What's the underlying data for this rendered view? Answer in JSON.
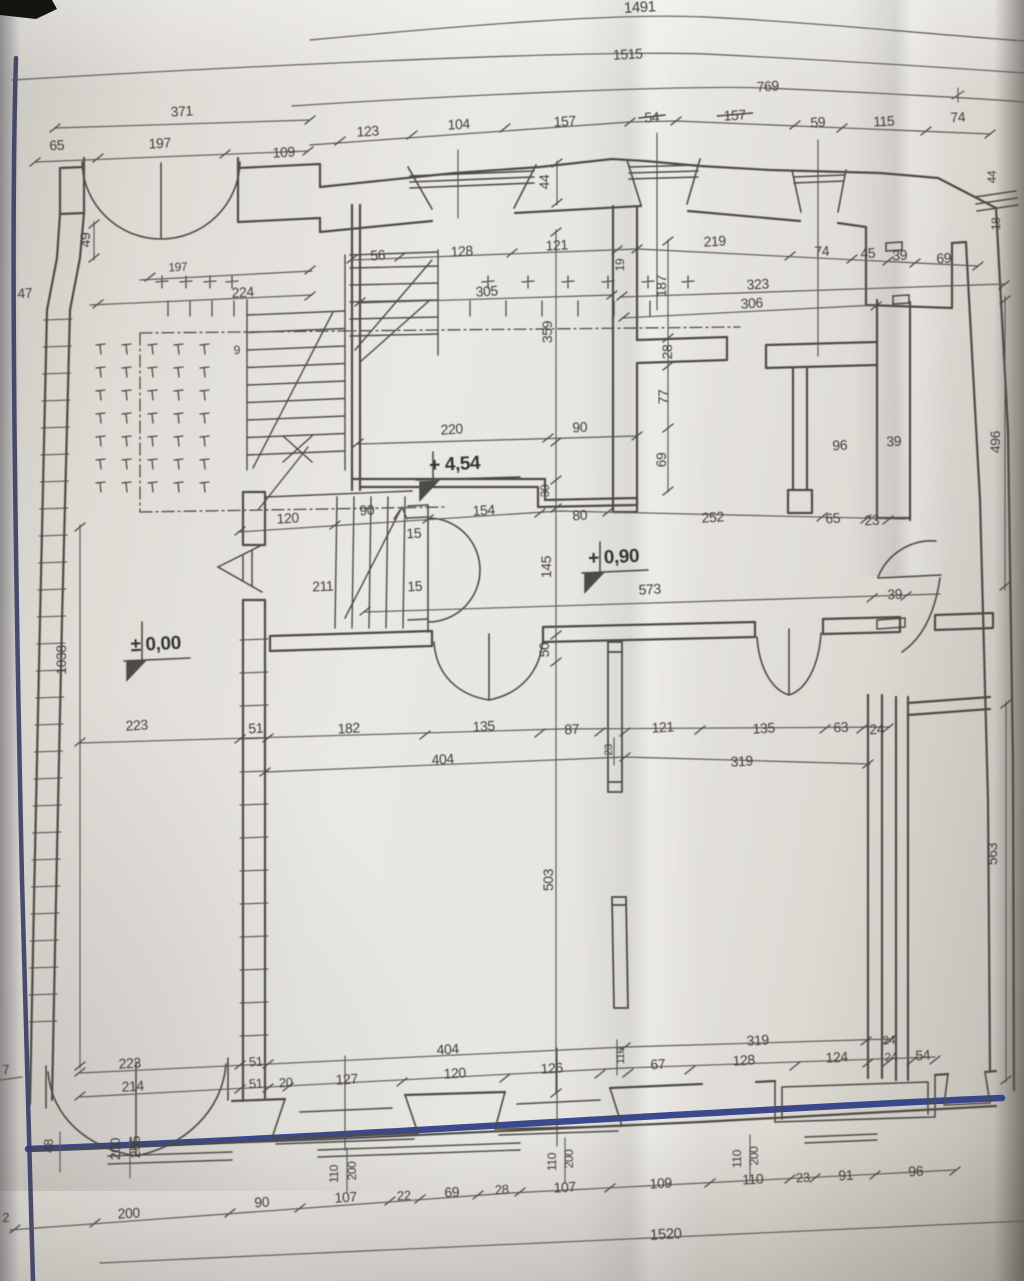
{
  "drawing": {
    "kind": "architectural-floor-plan-photo",
    "elevation_markers": [
      "+ 4,54",
      "+ 0,90",
      "± 0,00"
    ],
    "overall_dimensions": [
      "1491",
      "1515",
      "769",
      "1520",
      "1038"
    ]
  },
  "colors": {
    "ink": "#4d4b45",
    "dim_line": "#5b5952",
    "label": "#3f3d37",
    "paper_light": "#eae8e3",
    "paper_dark": "#c6c3bd",
    "blue_edge": "#383c63",
    "blue_facade": "#2e3c86"
  },
  "labels": [
    {
      "t": "1491",
      "x": 640,
      "y": 12,
      "fs": 15
    },
    {
      "t": "1515",
      "x": 628,
      "y": 59
    },
    {
      "t": "769",
      "x": 768,
      "y": 91
    },
    {
      "t": "371",
      "x": 182,
      "y": 116
    },
    {
      "t": "123",
      "x": 368,
      "y": 136
    },
    {
      "t": "104",
      "x": 459,
      "y": 129
    },
    {
      "t": "157",
      "x": 565,
      "y": 126
    },
    {
      "t": "54",
      "x": 652,
      "y": 122,
      "strike": true
    },
    {
      "t": "157",
      "x": 735,
      "y": 120,
      "strike": true
    },
    {
      "t": "59",
      "x": 818,
      "y": 127
    },
    {
      "t": "115",
      "x": 884,
      "y": 126
    },
    {
      "t": "74",
      "x": 958,
      "y": 122
    },
    {
      "t": "65",
      "x": 57,
      "y": 150
    },
    {
      "t": "197",
      "x": 160,
      "y": 148
    },
    {
      "t": "109",
      "x": 284,
      "y": 157
    },
    {
      "t": "47",
      "x": 25,
      "y": 298
    },
    {
      "t": "49",
      "x": 90,
      "y": 240,
      "r": -90
    },
    {
      "t": "197",
      "x": 178,
      "y": 271,
      "fs": 12
    },
    {
      "t": "224",
      "x": 243,
      "y": 297
    },
    {
      "t": "9",
      "x": 237,
      "y": 354,
      "fs": 12
    },
    {
      "t": "44",
      "x": 549,
      "y": 182,
      "r": -90
    },
    {
      "t": "56",
      "x": 378,
      "y": 260
    },
    {
      "t": "128",
      "x": 462,
      "y": 256
    },
    {
      "t": "121",
      "x": 557,
      "y": 250
    },
    {
      "t": "19",
      "x": 624,
      "y": 265,
      "r": -90,
      "fs": 12
    },
    {
      "t": "187",
      "x": 666,
      "y": 286,
      "r": -90
    },
    {
      "t": "219",
      "x": 715,
      "y": 246
    },
    {
      "t": "74",
      "x": 822,
      "y": 256
    },
    {
      "t": "45",
      "x": 868,
      "y": 258
    },
    {
      "t": "39",
      "x": 900,
      "y": 260
    },
    {
      "t": "69",
      "x": 944,
      "y": 263
    },
    {
      "t": "323",
      "x": 758,
      "y": 289
    },
    {
      "t": "306",
      "x": 752,
      "y": 308
    },
    {
      "t": "305",
      "x": 487,
      "y": 296
    },
    {
      "t": "359",
      "x": 552,
      "y": 332,
      "r": -90
    },
    {
      "t": "28",
      "x": 672,
      "y": 352,
      "r": -90
    },
    {
      "t": "77",
      "x": 668,
      "y": 397,
      "r": -90
    },
    {
      "t": "69",
      "x": 666,
      "y": 460,
      "r": -90
    },
    {
      "t": "44",
      "x": 996,
      "y": 177,
      "r": -90,
      "fs": 12
    },
    {
      "t": "18",
      "x": 1000,
      "y": 224,
      "r": -90,
      "fs": 12
    },
    {
      "t": "496",
      "x": 1000,
      "y": 442,
      "r": -90
    },
    {
      "t": "220",
      "x": 452,
      "y": 434
    },
    {
      "t": "90",
      "x": 580,
      "y": 432
    },
    {
      "t": "96",
      "x": 840,
      "y": 450
    },
    {
      "t": "39",
      "x": 894,
      "y": 446
    },
    {
      "t": "+ 4,54",
      "x": 455,
      "y": 470,
      "fs": 19,
      "b": 1
    },
    {
      "t": "120",
      "x": 288,
      "y": 523
    },
    {
      "t": "90",
      "x": 367,
      "y": 515
    },
    {
      "t": "154",
      "x": 484,
      "y": 515
    },
    {
      "t": "80",
      "x": 580,
      "y": 520
    },
    {
      "t": "252",
      "x": 713,
      "y": 522
    },
    {
      "t": "65",
      "x": 833,
      "y": 523
    },
    {
      "t": "23",
      "x": 872,
      "y": 525
    },
    {
      "t": "15",
      "x": 414,
      "y": 538
    },
    {
      "t": "15",
      "x": 415,
      "y": 591
    },
    {
      "t": "211",
      "x": 323,
      "y": 591
    },
    {
      "t": "145",
      "x": 551,
      "y": 567,
      "r": -90
    },
    {
      "t": "30",
      "x": 549,
      "y": 491,
      "r": -90,
      "fs": 12
    },
    {
      "t": "50",
      "x": 549,
      "y": 650,
      "r": -90
    },
    {
      "t": "+ 0,90",
      "x": 614,
      "y": 563,
      "fs": 19,
      "b": 1
    },
    {
      "t": "573",
      "x": 650,
      "y": 594
    },
    {
      "t": "39",
      "x": 895,
      "y": 599
    },
    {
      "t": "± 0,00",
      "x": 156,
      "y": 650,
      "fs": 19,
      "b": 1
    },
    {
      "t": "1038",
      "x": 66,
      "y": 660,
      "r": -90
    },
    {
      "t": "223",
      "x": 137,
      "y": 730
    },
    {
      "t": "51",
      "x": 256,
      "y": 733
    },
    {
      "t": "182",
      "x": 349,
      "y": 733
    },
    {
      "t": "135",
      "x": 484,
      "y": 731
    },
    {
      "t": "87",
      "x": 572,
      "y": 734
    },
    {
      "t": "121",
      "x": 663,
      "y": 732
    },
    {
      "t": "135",
      "x": 764,
      "y": 733
    },
    {
      "t": "63",
      "x": 841,
      "y": 732
    },
    {
      "t": "24",
      "x": 877,
      "y": 734
    },
    {
      "t": "404",
      "x": 443,
      "y": 764
    },
    {
      "t": "319",
      "x": 742,
      "y": 766
    },
    {
      "t": "23",
      "x": 612,
      "y": 750,
      "r": -90,
      "fs": 11
    },
    {
      "t": "503",
      "x": 553,
      "y": 880,
      "r": -90
    },
    {
      "t": "563",
      "x": 997,
      "y": 854,
      "r": -90
    },
    {
      "t": "404",
      "x": 448,
      "y": 1054
    },
    {
      "t": "319",
      "x": 758,
      "y": 1045
    },
    {
      "t": "24",
      "x": 889,
      "y": 1044,
      "fs": 12
    },
    {
      "t": "223",
      "x": 130,
      "y": 1068
    },
    {
      "t": "214",
      "x": 133,
      "y": 1091
    },
    {
      "t": "51",
      "x": 256,
      "y": 1066,
      "fs": 13
    },
    {
      "t": "51",
      "x": 256,
      "y": 1088,
      "fs": 13
    },
    {
      "t": "20",
      "x": 286,
      "y": 1087,
      "fs": 13
    },
    {
      "t": "127",
      "x": 347,
      "y": 1084
    },
    {
      "t": "120",
      "x": 455,
      "y": 1078
    },
    {
      "t": "126",
      "x": 552,
      "y": 1073
    },
    {
      "t": "110",
      "x": 624,
      "y": 1056,
      "r": -90,
      "fs": 11
    },
    {
      "t": "67",
      "x": 658,
      "y": 1069
    },
    {
      "t": "128",
      "x": 744,
      "y": 1065
    },
    {
      "t": "124",
      "x": 837,
      "y": 1062
    },
    {
      "t": "24",
      "x": 891,
      "y": 1061,
      "fs": 12
    },
    {
      "t": "54",
      "x": 923,
      "y": 1060
    },
    {
      "t": "7",
      "x": 6,
      "y": 1074,
      "fs": 13
    },
    {
      "t": "48",
      "x": 53,
      "y": 1146,
      "r": -90,
      "fs": 13
    },
    {
      "t": "200",
      "x": 120,
      "y": 1149,
      "r": -90
    },
    {
      "t": "255",
      "x": 140,
      "y": 1147,
      "r": -90
    },
    {
      "t": "110",
      "x": 338,
      "y": 1174,
      "r": -90,
      "fs": 12
    },
    {
      "t": "200",
      "x": 356,
      "y": 1171,
      "r": -90,
      "fs": 12
    },
    {
      "t": "110",
      "x": 556,
      "y": 1162,
      "r": -90,
      "fs": 12
    },
    {
      "t": "200",
      "x": 573,
      "y": 1159,
      "r": -90,
      "fs": 12
    },
    {
      "t": "110",
      "x": 741,
      "y": 1159,
      "r": -90,
      "fs": 12
    },
    {
      "t": "200",
      "x": 758,
      "y": 1156,
      "r": -90,
      "fs": 12
    },
    {
      "t": "2",
      "x": 6,
      "y": 1222,
      "fs": 13
    },
    {
      "t": "200",
      "x": 129,
      "y": 1218
    },
    {
      "t": "90",
      "x": 262,
      "y": 1207
    },
    {
      "t": "107",
      "x": 346,
      "y": 1202
    },
    {
      "t": "22",
      "x": 404,
      "y": 1200,
      "fs": 13
    },
    {
      "t": "69",
      "x": 452,
      "y": 1197
    },
    {
      "t": "28",
      "x": 502,
      "y": 1194,
      "fs": 13
    },
    {
      "t": "107",
      "x": 565,
      "y": 1192
    },
    {
      "t": "109",
      "x": 661,
      "y": 1188
    },
    {
      "t": "110",
      "x": 753,
      "y": 1184
    },
    {
      "t": "23",
      "x": 803,
      "y": 1182,
      "fs": 13
    },
    {
      "t": "91",
      "x": 846,
      "y": 1180
    },
    {
      "t": "96",
      "x": 916,
      "y": 1176
    },
    {
      "t": "1520",
      "x": 666,
      "y": 1239,
      "fs": 15
    }
  ]
}
